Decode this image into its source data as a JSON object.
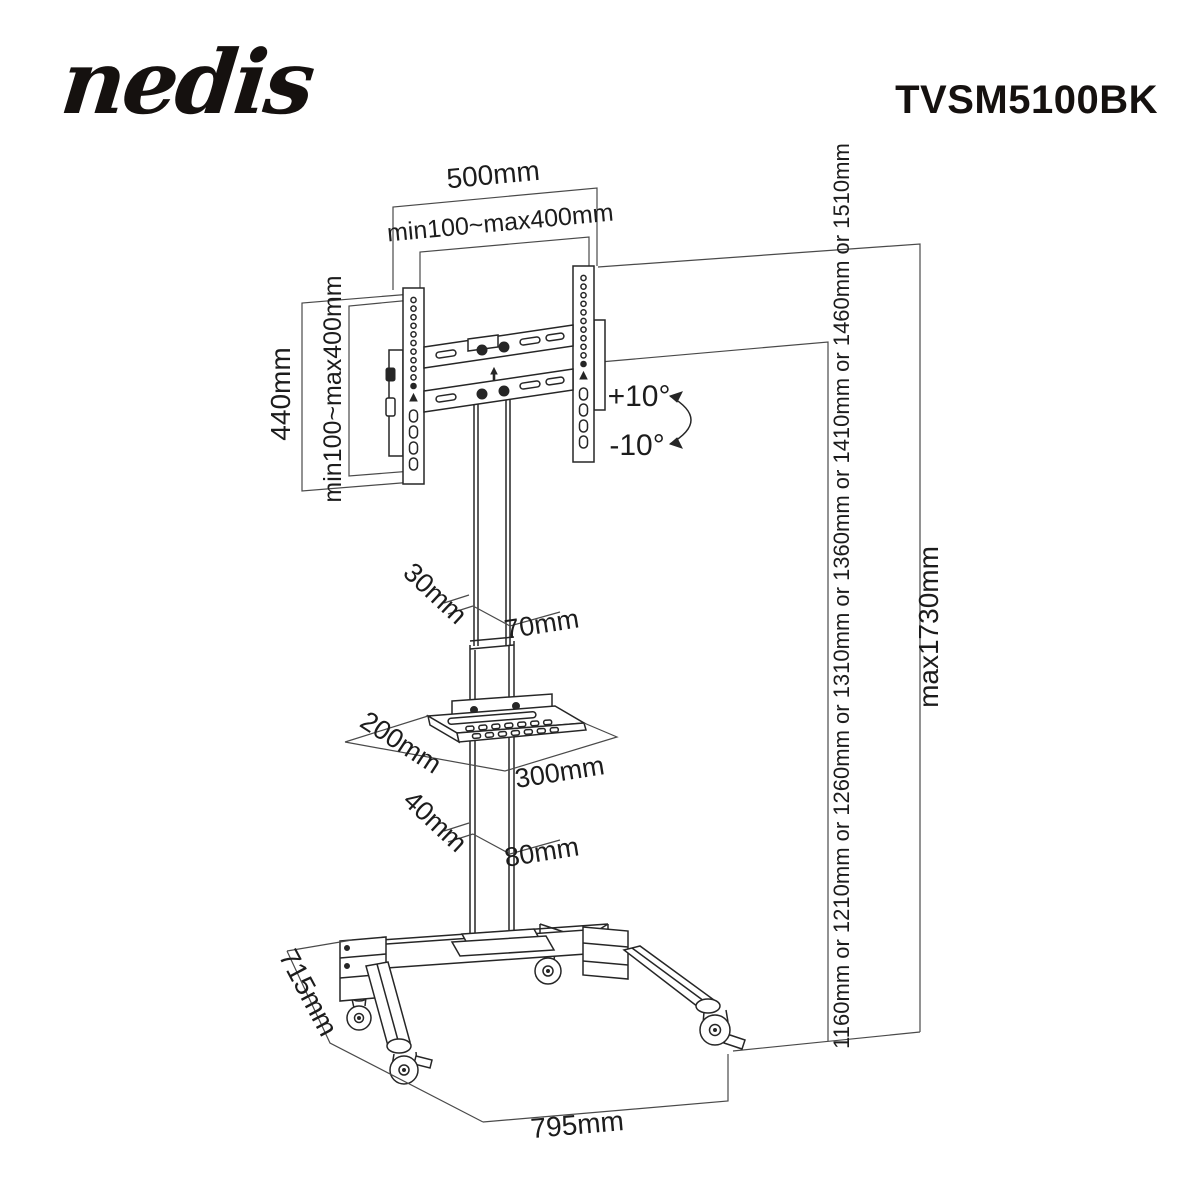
{
  "header": {
    "logo_text": "nedis",
    "product_code": "TVSM5100BK"
  },
  "diagram": {
    "labels": {
      "vesa_plate_width": "500mm",
      "vesa_width_range": "min100~max400mm",
      "vesa_plate_height": "440mm",
      "vesa_height_range": "min100~max400mm",
      "tilt_up": "+10°",
      "tilt_down": "-10°",
      "upper_pole_depth": "30mm",
      "upper_pole_width": "70mm",
      "shelf_depth": "200mm",
      "shelf_width": "300mm",
      "lower_pole_depth": "40mm",
      "lower_pole_width": "80mm",
      "base_depth": "715mm",
      "base_width": "795mm",
      "screen_center_heights": "1160mm or 1210mm or 1260mm or 1310mm or 1360mm or 1410mm or 1460mm or 1510mm",
      "max_total_height": "max1730mm"
    },
    "colors": {
      "line": "#262626",
      "dimension_line": "#4a4a4a",
      "background": "#ffffff"
    }
  }
}
